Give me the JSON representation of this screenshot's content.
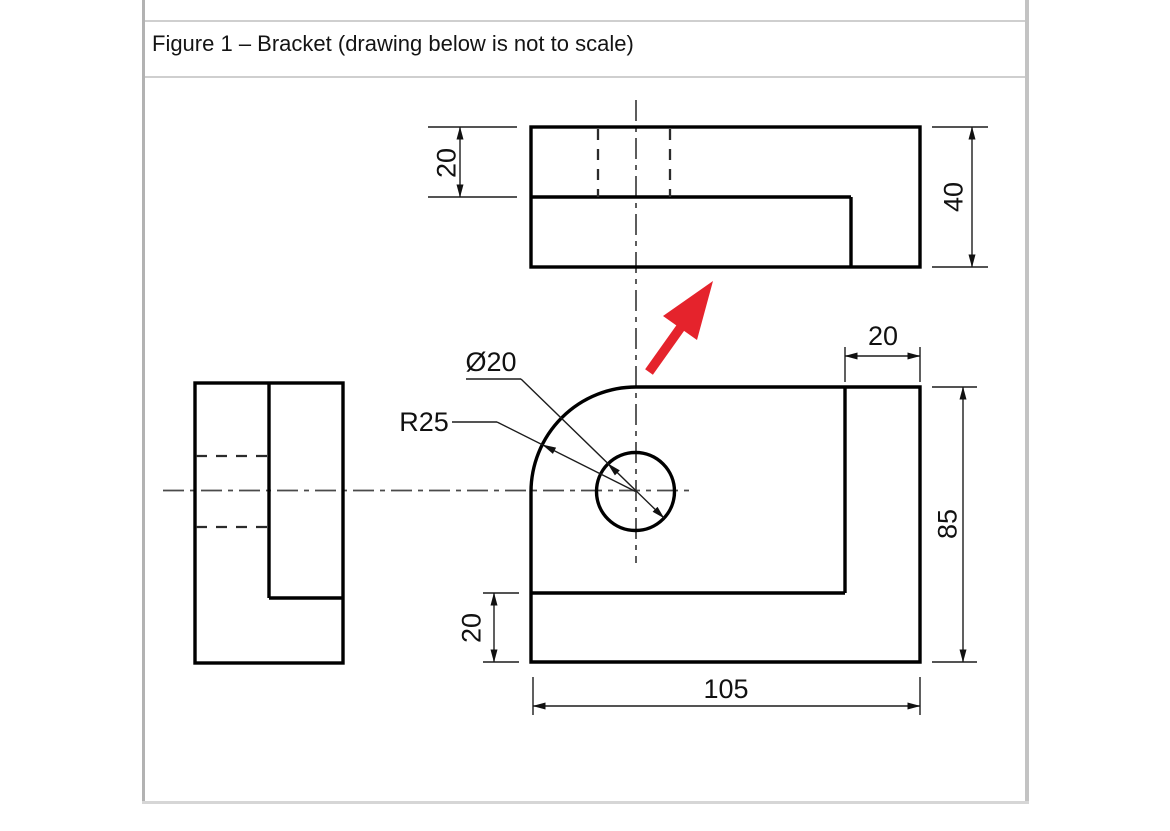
{
  "title": "Figure 1 – Bracket (drawing below is not to scale)",
  "drawing": {
    "part": "Bracket",
    "dims": {
      "top_view_height": "20",
      "top_view_total": "40",
      "front_wall_width": "20",
      "front_height": "85",
      "front_base_height": "20",
      "front_width": "105",
      "hole_diameter": "Ø20",
      "corner_radius": "R25"
    },
    "colors": {
      "outline": "#000000",
      "centerline": "#4a4a4a",
      "direction_arrow": "#e5232c",
      "table_border": "#b7b7b7"
    }
  }
}
